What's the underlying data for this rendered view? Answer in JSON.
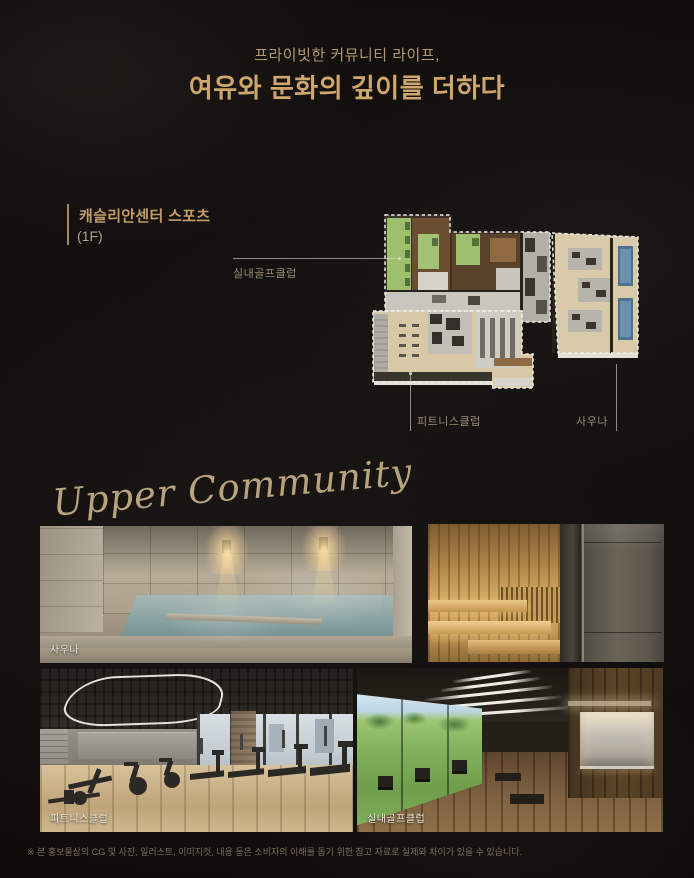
{
  "header": {
    "subtitle": "프라이빗한 커뮤니티 라이프,",
    "title": "여유와 문화의 깊이를 더하다"
  },
  "floorplan": {
    "title": "캐슬리안센터 스포츠",
    "floor": "(1F)",
    "callouts": {
      "golf": "실내골프클럽",
      "fitness": "피트니스클럽",
      "sauna": "사우나"
    }
  },
  "gallery": {
    "heading": "Upper Community",
    "photos": [
      {
        "id": "sauna-bath",
        "caption": "사우나"
      },
      {
        "id": "dry-sauna",
        "caption": ""
      },
      {
        "id": "fitness-club",
        "caption": "피트니스클럽"
      },
      {
        "id": "indoor-golf-club",
        "caption": "실내골프클럽"
      }
    ]
  },
  "footer": {
    "disclaimer": "※ 본 홍보물상의 CG 및 사진, 일러스트, 이미지컷, 내용 등은 소비자의 이해를 돕기 위한 참고 자료로 실제와 차이가 있을 수 있습니다."
  },
  "colors": {
    "background": "#141110",
    "title_gold": "#cfa76c",
    "subtitle_tan": "#b49870",
    "accent_bar": "#a8895c",
    "callout_text": "#9a8b75",
    "plan_green": "#9ebf6d",
    "plan_tan": "#d9c8a5",
    "plan_pool_blue": "#4d7191"
  }
}
